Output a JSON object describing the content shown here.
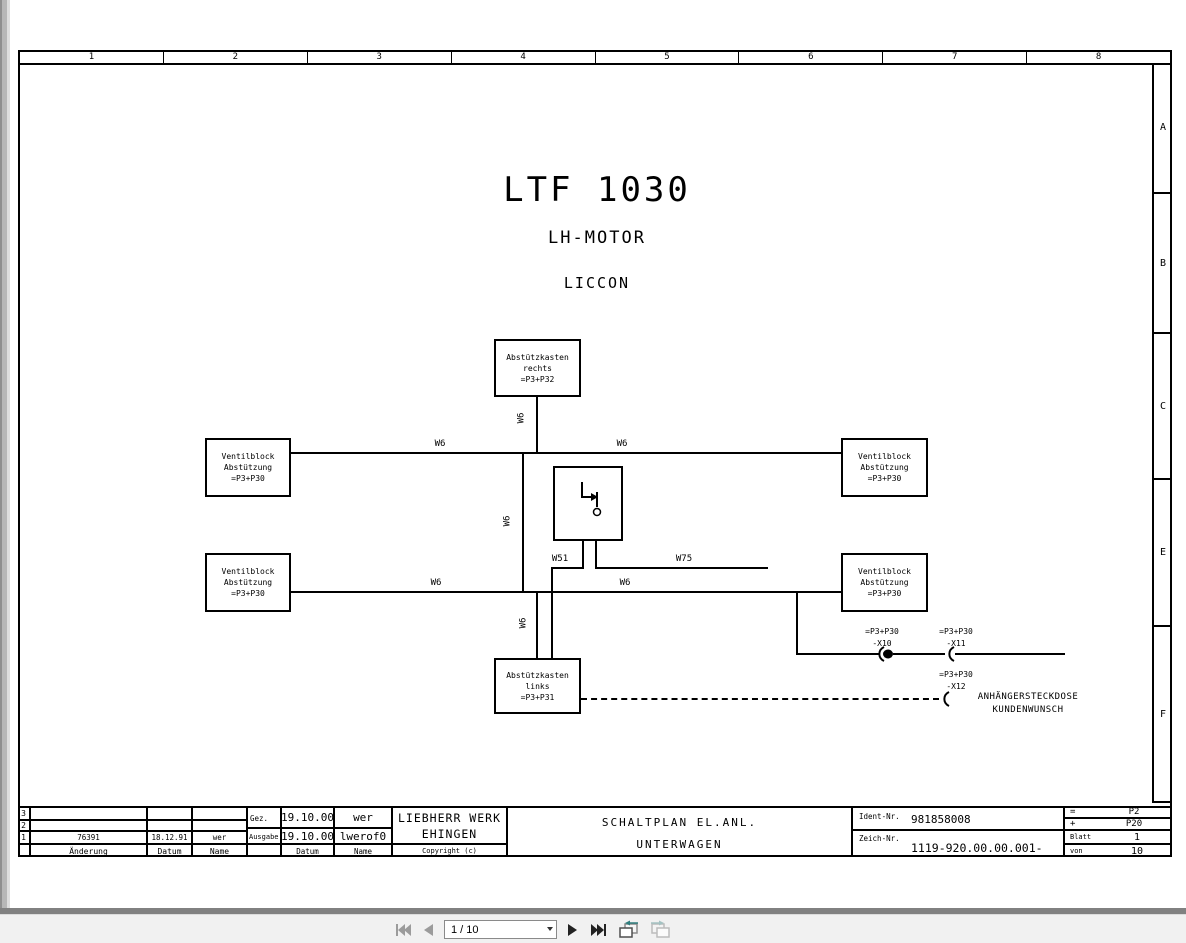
{
  "titles": {
    "main": "LTF 1030",
    "sub1": "LH-MOTOR",
    "sub2": "LICCON"
  },
  "frame": {
    "columns": [
      "1",
      "2",
      "3",
      "4",
      "5",
      "6",
      "7",
      "8"
    ],
    "rows": [
      "A",
      "B",
      "C",
      "E",
      "F"
    ]
  },
  "diagram": {
    "boxes": {
      "abstuetzkasten_rechts": [
        "Abstützkasten",
        "rechts",
        "=P3+P32"
      ],
      "ventilblock": [
        "Ventilblock",
        "Abstützung",
        "=P3+P30"
      ],
      "abstuetzkasten_links": [
        "Abstützkasten",
        "links",
        "=P3+P31"
      ]
    },
    "wire_labels": {
      "w6": "W6",
      "w51": "W51",
      "w75": "W75"
    },
    "connectors": {
      "x10": {
        "ref": "=P3+P30",
        "name": "-X10"
      },
      "x11": {
        "ref": "=P3+P30",
        "name": "-X11"
      },
      "x12": {
        "ref": "=P3+P30",
        "name": "-X12"
      }
    },
    "note": {
      "line1": "ANHÄNGERSTECKDOSE",
      "line2": "KUNDENWUNSCH"
    }
  },
  "titleblock": {
    "revision": {
      "rows": [
        {
          "num": "3",
          "aenderung": "",
          "datum": "",
          "name": ""
        },
        {
          "num": "2",
          "aenderung": "",
          "datum": "",
          "name": ""
        },
        {
          "num": "1",
          "aenderung": "76391",
          "datum": "18.12.91",
          "name": "wer"
        }
      ],
      "header": {
        "aenderung": "Änderung",
        "datum": "Datum",
        "name": "Name"
      }
    },
    "issue": {
      "gez_label": "Gez.",
      "gez_datum": "19.10.00",
      "gez_name": "wer",
      "ausgabe_label": "Ausgabe",
      "ausgabe_datum": "19.10.00",
      "ausgabe_name": "lwerof0",
      "header_datum": "Datum",
      "header_name": "Name"
    },
    "company": {
      "line1": "LIEBHERR WERK",
      "line2": "EHINGEN",
      "copyright": "Copyright (c)"
    },
    "doc_title": {
      "line1": "SCHALTPLAN EL.ANL.",
      "line2": "UNTERWAGEN"
    },
    "ident": {
      "label": "Ident-Nr.",
      "value": "981858008"
    },
    "zeich": {
      "label": "Zeich-Nr.",
      "value": "1119-920.00.00.001-001"
    },
    "refs": [
      {
        "label": "=",
        "value": "P2"
      },
      {
        "label": "+",
        "value": "P20"
      },
      {
        "label": "Blatt",
        "value": "1"
      },
      {
        "label": "von",
        "value": "10"
      }
    ]
  },
  "toolbar": {
    "page_value": "1 / 10",
    "icons": {
      "first": "first-page-icon",
      "prev": "previous-page-icon",
      "next": "next-page-icon",
      "last": "last-page-icon",
      "prev_view": "previous-view-icon",
      "next_view": "next-view-icon"
    }
  },
  "colors": {
    "line": "#000000",
    "page_bg": "#ffffff",
    "toolbar_bg": "#f1f1f1",
    "shadow": "#818181",
    "disabled_icon": "#9b9b9b",
    "enabled_icon": "#222222",
    "view_arrow": "#2e7d7d"
  }
}
